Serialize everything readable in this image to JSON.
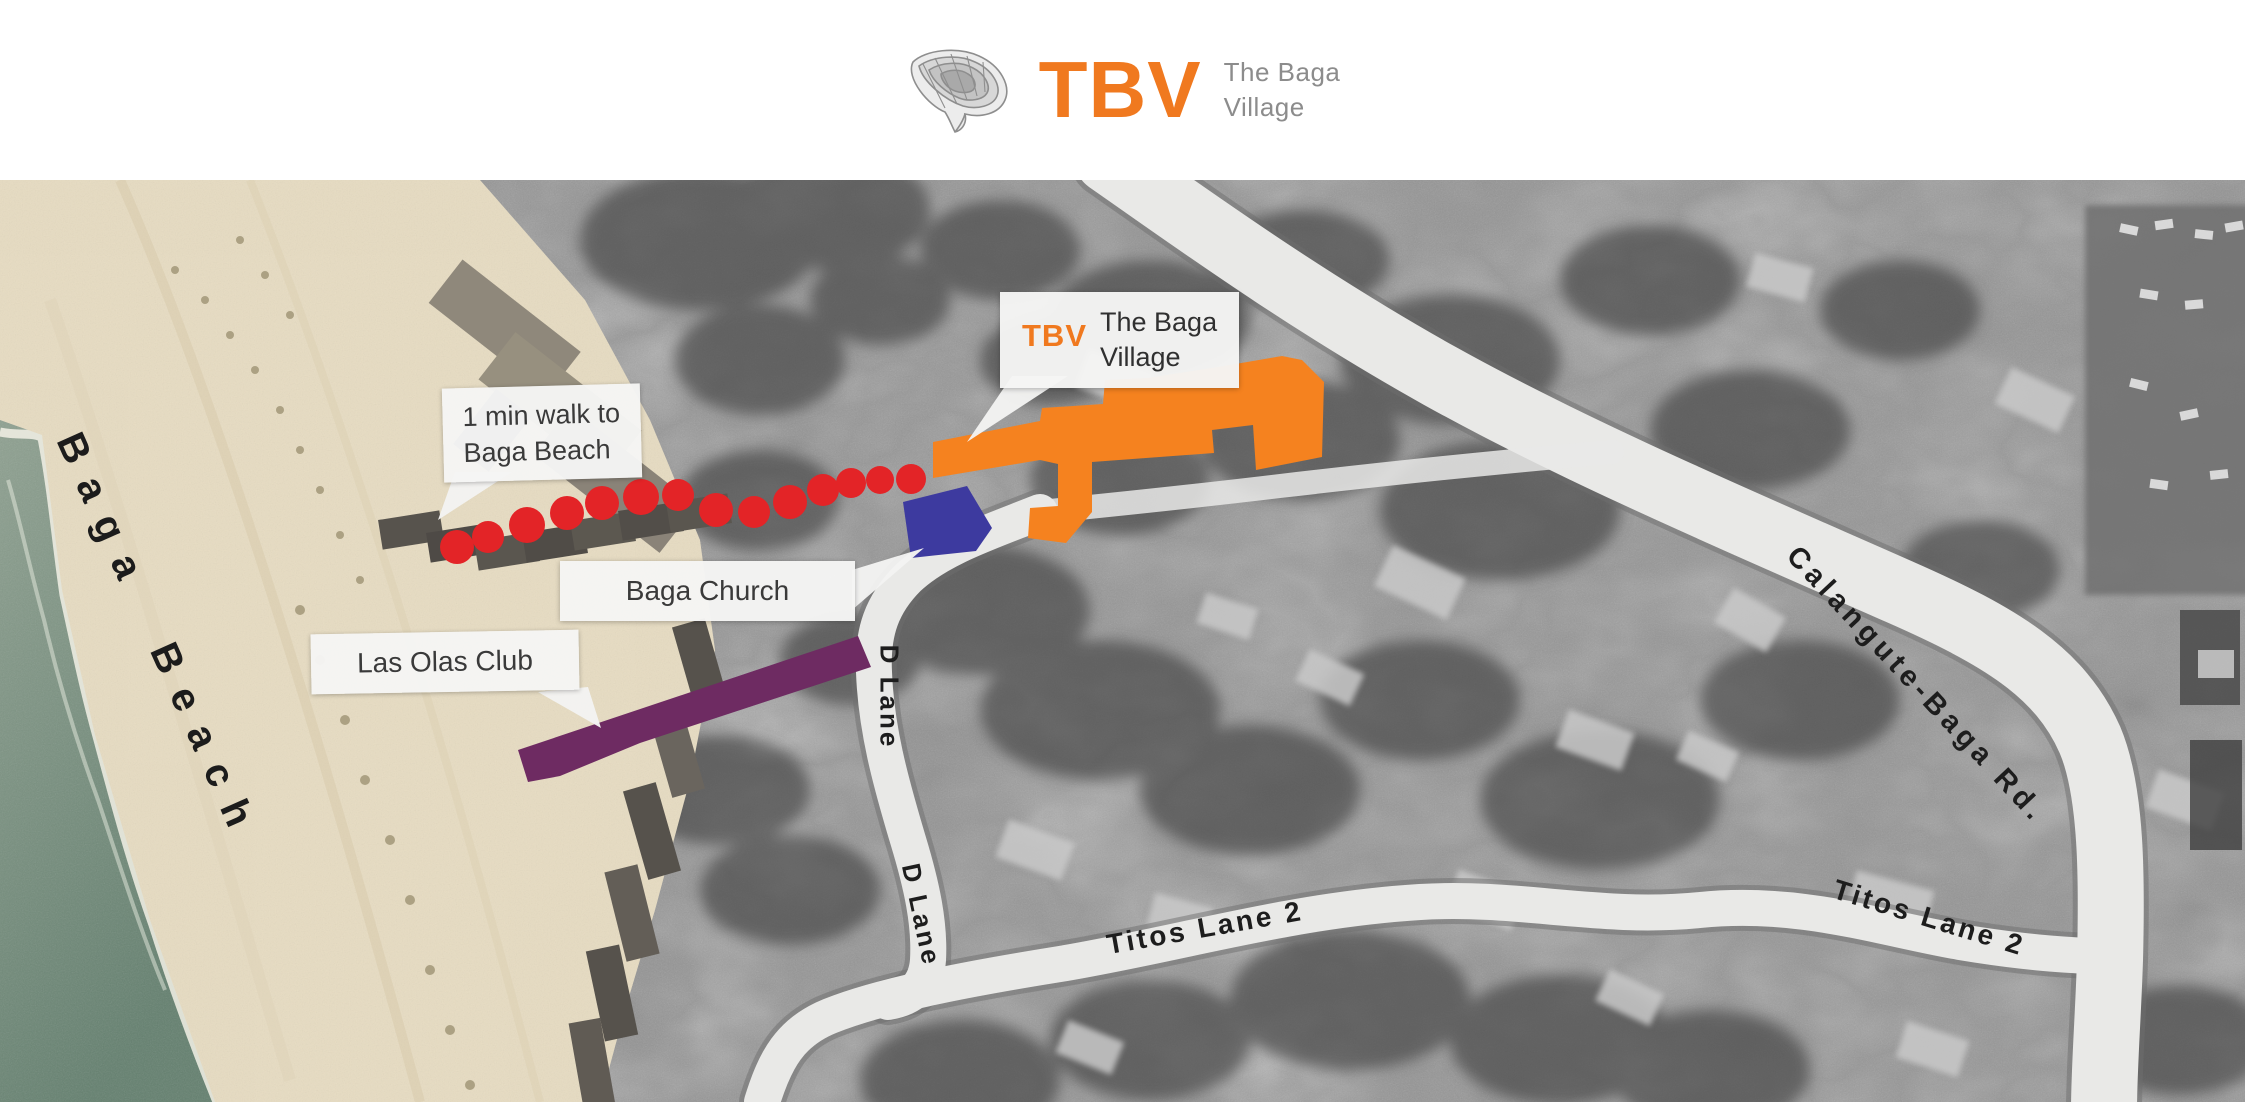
{
  "header": {
    "brand_abbr": "TBV",
    "brand_line1": "The Baga",
    "brand_line2": "Village"
  },
  "map": {
    "callouts": {
      "walk_line1": "1 min walk to",
      "walk_line2": "Baga Beach",
      "tbv_abbr": "TBV",
      "tbv_line1": "The Baga",
      "tbv_line2": "Village",
      "church": "Baga Church",
      "las_olas": "Las Olas Club"
    },
    "labels": {
      "beach": "Baga Beach",
      "calangute": "Calangute-Baga Rd.",
      "titos_a": "Titos Lane 2",
      "titos_b": "Titos Lane 2",
      "d_lane_a": "D Lane",
      "d_lane_b": "D Lane"
    },
    "colors": {
      "tbv_building": "#F5821F",
      "church_building": "#3D3A9F",
      "las_olas_building": "#6E2B62",
      "walk_dots": "#E32427",
      "brand_orange": "#F0791F",
      "brand_gray": "#8C8C8C",
      "road": "#E9E9E7",
      "sand": "#E7DCC2",
      "sea": "#7B9081"
    }
  }
}
